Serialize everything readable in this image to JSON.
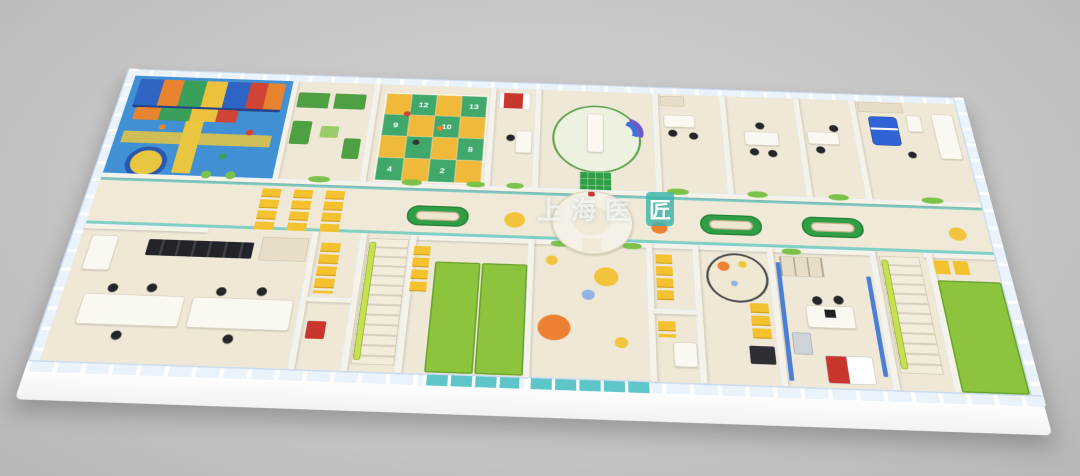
{
  "watermark": {
    "prefix": "上海医",
    "badge": "匠"
  },
  "game_board": {
    "cells": [
      "",
      "12",
      "",
      "13",
      "9",
      "",
      "10",
      "",
      "",
      "",
      "",
      "8",
      "4",
      "",
      "2",
      ""
    ]
  },
  "palette": {
    "bg": "#c6c6c6",
    "wall_cap": "#ccdcf2",
    "wall_face": "#f7f2e6",
    "wall_tan": "#e7ddc8",
    "floor_room": "#efe8d6",
    "floor_corridor": "#f0e9d8",
    "glass": "#eaf2fb",
    "teal": "#76ccc3",
    "teal_glass": "#5ec5c9",
    "playground_blue": "#4190d4",
    "path_yellow": "#e9c63f",
    "board_green": "#41a86c",
    "board_yellow": "#f0b93a",
    "chair_yellow": "#f5c22f",
    "sofa_green": "#4ea043",
    "mat_green": "#8cc43e",
    "bench_green": "#2f9e44",
    "bench_seat": "#efe6d0",
    "decal_green": "#7cc24a",
    "dot_orange": "#ed8132",
    "dot_yellow": "#f2c33c",
    "dot_blue": "#92b4e4",
    "bed_red": "#c8362e",
    "bed_blue": "#3064d6",
    "equip_purple": "#6f58c8",
    "chair_black": "#26262a",
    "counter_white": "#fbf8f2",
    "stairs_rail": "#c6e052"
  }
}
